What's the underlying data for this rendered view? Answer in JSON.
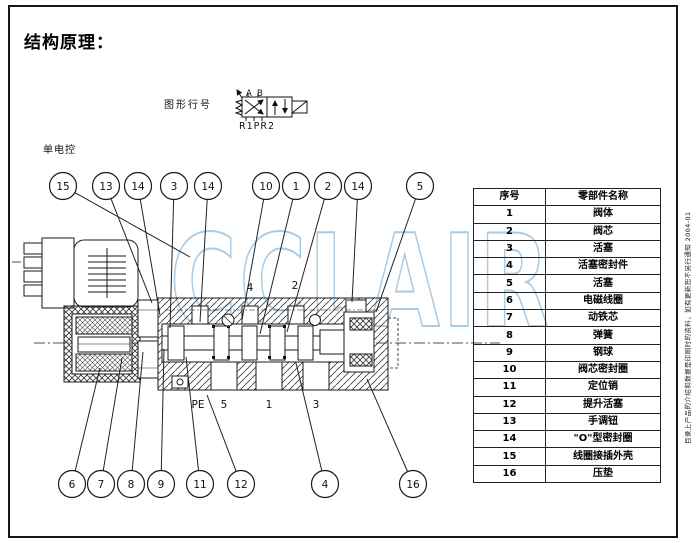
{
  "page": {
    "title": "结构原理：",
    "side_note": "目录上产品的介绍和数据是印刷时的资料，如有更新恕不另行通知 2004-01"
  },
  "schematic": {
    "label": "图形行号",
    "port_a": "A",
    "port_b": "B",
    "ports_bottom": "R1PR2"
  },
  "drawing": {
    "control_label": "单电控",
    "watermark": "CCLAIR",
    "watermark_color": "#a9cbe4",
    "inner_labels": [
      {
        "t": "4",
        "x": 250,
        "y": 291
      },
      {
        "t": "2",
        "x": 295,
        "y": 289
      }
    ],
    "port_labels": [
      {
        "t": "PE",
        "x": 198
      },
      {
        "t": "5",
        "x": 224
      },
      {
        "t": "1",
        "x": 269
      },
      {
        "t": "3",
        "x": 316
      }
    ],
    "top_cy": 186,
    "top_callouts": [
      {
        "n": "15",
        "x": 63,
        "tx": 190,
        "ty": 257
      },
      {
        "n": "13",
        "x": 106,
        "tx": 152,
        "ty": 303
      },
      {
        "n": "14",
        "x": 138,
        "tx": 160,
        "ty": 315
      },
      {
        "n": "3",
        "x": 174,
        "tx": 170,
        "ty": 328
      },
      {
        "n": "14",
        "x": 208,
        "tx": 200,
        "ty": 322
      },
      {
        "n": "10",
        "x": 266,
        "tx": 242,
        "ty": 320
      },
      {
        "n": "1",
        "x": 296,
        "tx": 260,
        "ty": 334
      },
      {
        "n": "2",
        "x": 328,
        "tx": 287,
        "ty": 332
      },
      {
        "n": "14",
        "x": 358,
        "tx": 352,
        "ty": 302
      },
      {
        "n": "5",
        "x": 420,
        "tx": 376,
        "ty": 312
      }
    ],
    "bottom_cy": 484,
    "bottom_callouts": [
      {
        "n": "6",
        "x": 72,
        "tx": 100,
        "ty": 368
      },
      {
        "n": "7",
        "x": 101,
        "tx": 122,
        "ty": 358
      },
      {
        "n": "8",
        "x": 131,
        "tx": 143,
        "ty": 352
      },
      {
        "n": "9",
        "x": 161,
        "tx": 164,
        "ty": 349
      },
      {
        "n": "11",
        "x": 200,
        "tx": 186,
        "ty": 357
      },
      {
        "n": "12",
        "x": 241,
        "tx": 207,
        "ty": 395
      },
      {
        "n": "4",
        "x": 325,
        "tx": 296,
        "ty": 363
      },
      {
        "n": "16",
        "x": 413,
        "tx": 367,
        "ty": 379
      }
    ]
  },
  "table": {
    "headers": [
      "序号",
      "零部件名称"
    ],
    "rows": [
      [
        "1",
        "阀体"
      ],
      [
        "2",
        "阀芯"
      ],
      [
        "3",
        "活塞"
      ],
      [
        "4",
        "活塞密封件"
      ],
      [
        "5",
        "活塞"
      ],
      [
        "6",
        "电磁线圈"
      ],
      [
        "7",
        "动铁芯"
      ],
      [
        "8",
        "弹簧"
      ],
      [
        "9",
        "钢球"
      ],
      [
        "10",
        "阀芯密封圈"
      ],
      [
        "11",
        "定位销"
      ],
      [
        "12",
        "提升活塞"
      ],
      [
        "13",
        "手调钮"
      ],
      [
        "14",
        "\"O\"型密封圈"
      ],
      [
        "15",
        "线圈接插外壳"
      ],
      [
        "16",
        "压垫"
      ]
    ]
  }
}
